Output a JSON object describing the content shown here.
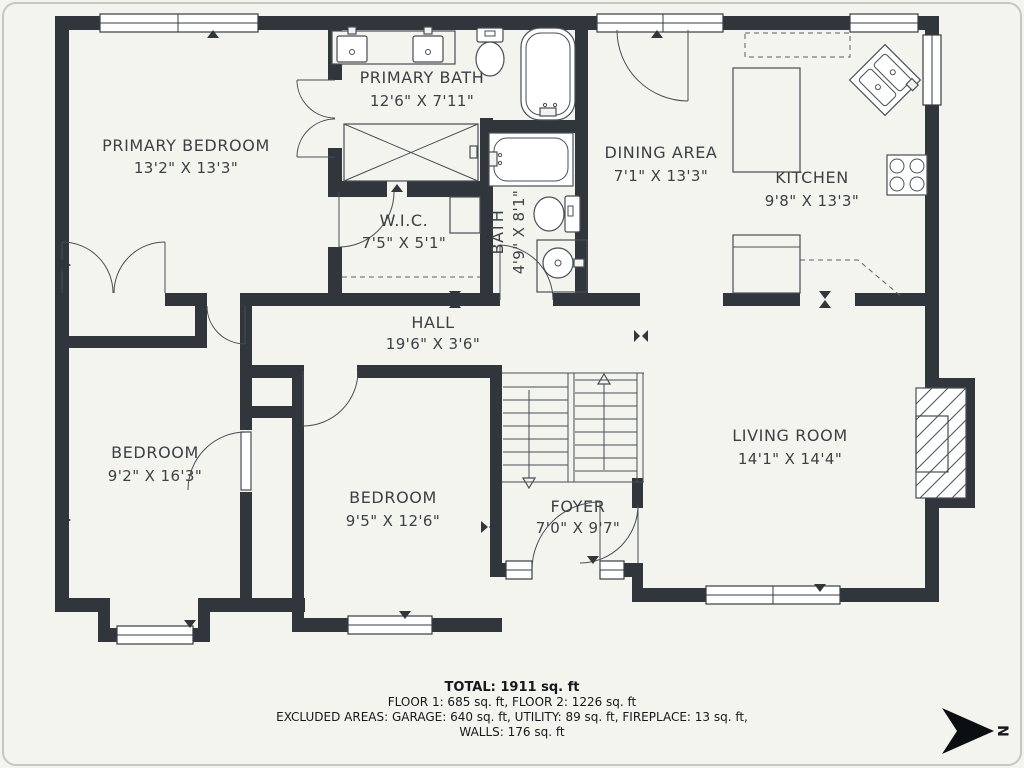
{
  "rooms": [
    {
      "name": "PRIMARY BEDROOM",
      "dims": "13'2\" X 13'3\""
    },
    {
      "name": "PRIMARY BATH",
      "dims": "12'6\" X 7'11\""
    },
    {
      "name": "W.I.C.",
      "dims": "7'5\" X 5'1\""
    },
    {
      "name": "BATH",
      "dims": "4'9\" X 8'1\""
    },
    {
      "name": "DINING AREA",
      "dims": "7'1\" X 13'3\""
    },
    {
      "name": "KITCHEN",
      "dims": "9'8\" X 13'3\""
    },
    {
      "name": "HALL",
      "dims": "19'6\" X 3'6\""
    },
    {
      "name": "BEDROOM",
      "dims": "9'2\" X 16'3\""
    },
    {
      "name": "BEDROOM",
      "dims": "9'5\" X 12'6\""
    },
    {
      "name": "FOYER",
      "dims": "7'0\" X 9'7\""
    },
    {
      "name": "LIVING ROOM",
      "dims": "14'1\" X 14'4\""
    }
  ],
  "summary": {
    "total": "TOTAL: 1911 sq. ft",
    "floors": "FLOOR 1: 685 sq. ft, FLOOR 2: 1226 sq. ft",
    "excluded": "EXCLUDED AREAS: GARAGE: 640 sq. ft, UTILITY: 89 sq. ft, FIREPLACE: 13 sq. ft,",
    "walls": "WALLS: 176 sq. ft"
  },
  "compass": {
    "label": "N"
  },
  "colors": {
    "wall": "#30363b",
    "background": "#f4f4ee",
    "line": "#474e54",
    "text": "#3b4145"
  }
}
